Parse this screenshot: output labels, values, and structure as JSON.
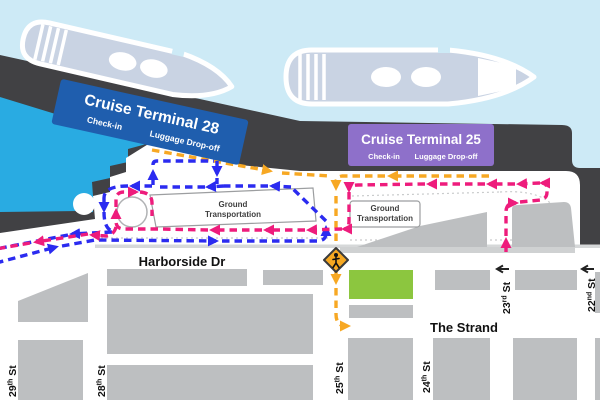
{
  "terminals": [
    {
      "id": "terminal-28",
      "title": "Cruise Terminal 28",
      "checkin": "Check-in",
      "luggage": "Luggage Drop-off",
      "color": "#1f5eae"
    },
    {
      "id": "terminal-25",
      "title": "Cruise Terminal 25",
      "checkin": "Check-in",
      "luggage": "Luggage Drop-off",
      "color": "#8e70ca"
    }
  ],
  "ground": {
    "line1": "Ground",
    "line2": "Transportation"
  },
  "roads": {
    "harborside": "Harborside Dr",
    "strand": "The Strand"
  },
  "streets": [
    {
      "number": "29",
      "ordinal": "th",
      "street": " St",
      "full": "29th St"
    },
    {
      "number": "28",
      "ordinal": "th",
      "street": " St",
      "full": "28th St"
    },
    {
      "number": "25",
      "ordinal": "th",
      "street": " St",
      "full": "25th St"
    },
    {
      "number": "24",
      "ordinal": "th",
      "street": " St",
      "full": "24th St"
    },
    {
      "number": "23",
      "ordinal": "rd",
      "street": " St",
      "full": "23rd St"
    },
    {
      "number": "22",
      "ordinal": "nd",
      "street": " St",
      "full": "22nd St"
    }
  ],
  "routes": {
    "blue": {
      "name": "terminal-28-vehicle-route",
      "color": "#2b2bf0"
    },
    "pink": {
      "name": "terminal-25-vehicle-route",
      "color": "#ee1c7c"
    },
    "orange": {
      "name": "luggage-drop-off-route",
      "color": "#f7a823"
    }
  },
  "colors": {
    "water": "#cdeaf6",
    "harbor": "#29abe2",
    "pier": "#414144",
    "road": "#ffffff",
    "block": "#bdbfc1",
    "green_lot": "#8cc63f",
    "ship": "#c9d3e3",
    "sign": "#f6a821"
  },
  "icons": {
    "sign": "pedestrian-crossing-sign",
    "one_way": "one-way-left-arrow",
    "ships": "cruise-ship-icon"
  }
}
